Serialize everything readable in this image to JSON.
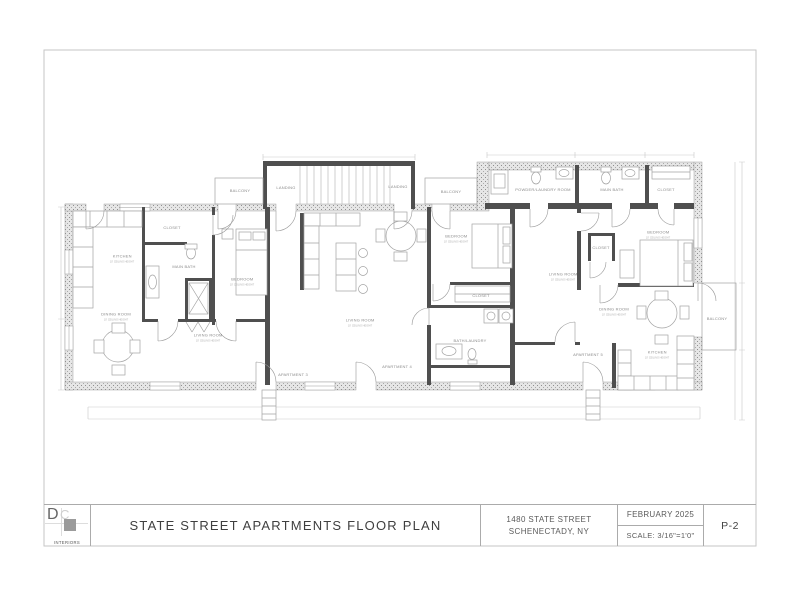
{
  "sheet": {
    "title_block": {
      "logo_d": "D",
      "logo_c": "C",
      "logo_subtitle": "INTERIORS",
      "title": "STATE STREET APARTMENTS FLOOR PLAN",
      "address_line1": "1480 STATE STREET",
      "address_line2": "SCHENECTADY, NY",
      "date": "FEBRUARY 2025",
      "scale": "SCALE: 3/16\"=1'0\"",
      "sheet_number": "P-2"
    }
  },
  "plan": {
    "labels": [
      {
        "text": "BALCONY"
      },
      {
        "text": "LANDING"
      },
      {
        "text": "LANDING"
      },
      {
        "text": "BALCONY"
      },
      {
        "text": "POWDER/LAUNDRY ROOM"
      },
      {
        "text": "MAIN BATH"
      },
      {
        "text": "CLOSET"
      },
      {
        "text": "KITCHEN",
        "sub": "10' CEILING HEIGHT"
      },
      {
        "text": "CLOSET"
      },
      {
        "text": "MAIN BATH"
      },
      {
        "text": "BEDROOM",
        "sub": "10' CEILING HEIGHT"
      },
      {
        "text": "DINING ROOM",
        "sub": "10' CEILING HEIGHT"
      },
      {
        "text": "LIVING ROOM",
        "sub": "10' CEILING HEIGHT"
      },
      {
        "text": "LIVING ROOM",
        "sub": "10' CEILING HEIGHT"
      },
      {
        "text": "BEDROOM",
        "sub": "10' CEILING HEIGHT"
      },
      {
        "text": "CLOSET"
      },
      {
        "text": "BATH/LAUNDRY"
      },
      {
        "text": "BEDROOM",
        "sub": "10' CEILING HEIGHT"
      },
      {
        "text": "LIVING ROOM",
        "sub": "10' CEILING HEIGHT"
      },
      {
        "text": "CLOSET"
      },
      {
        "text": "DINING ROOM",
        "sub": "10' CEILING HEIGHT"
      },
      {
        "text": "KITCHEN",
        "sub": "10' CEILING HEIGHT"
      },
      {
        "text": "BALCONY"
      },
      {
        "text": "APARTMENT 3"
      },
      {
        "text": "APARTMENT 4"
      },
      {
        "text": "APARTMENT 5"
      }
    ]
  }
}
